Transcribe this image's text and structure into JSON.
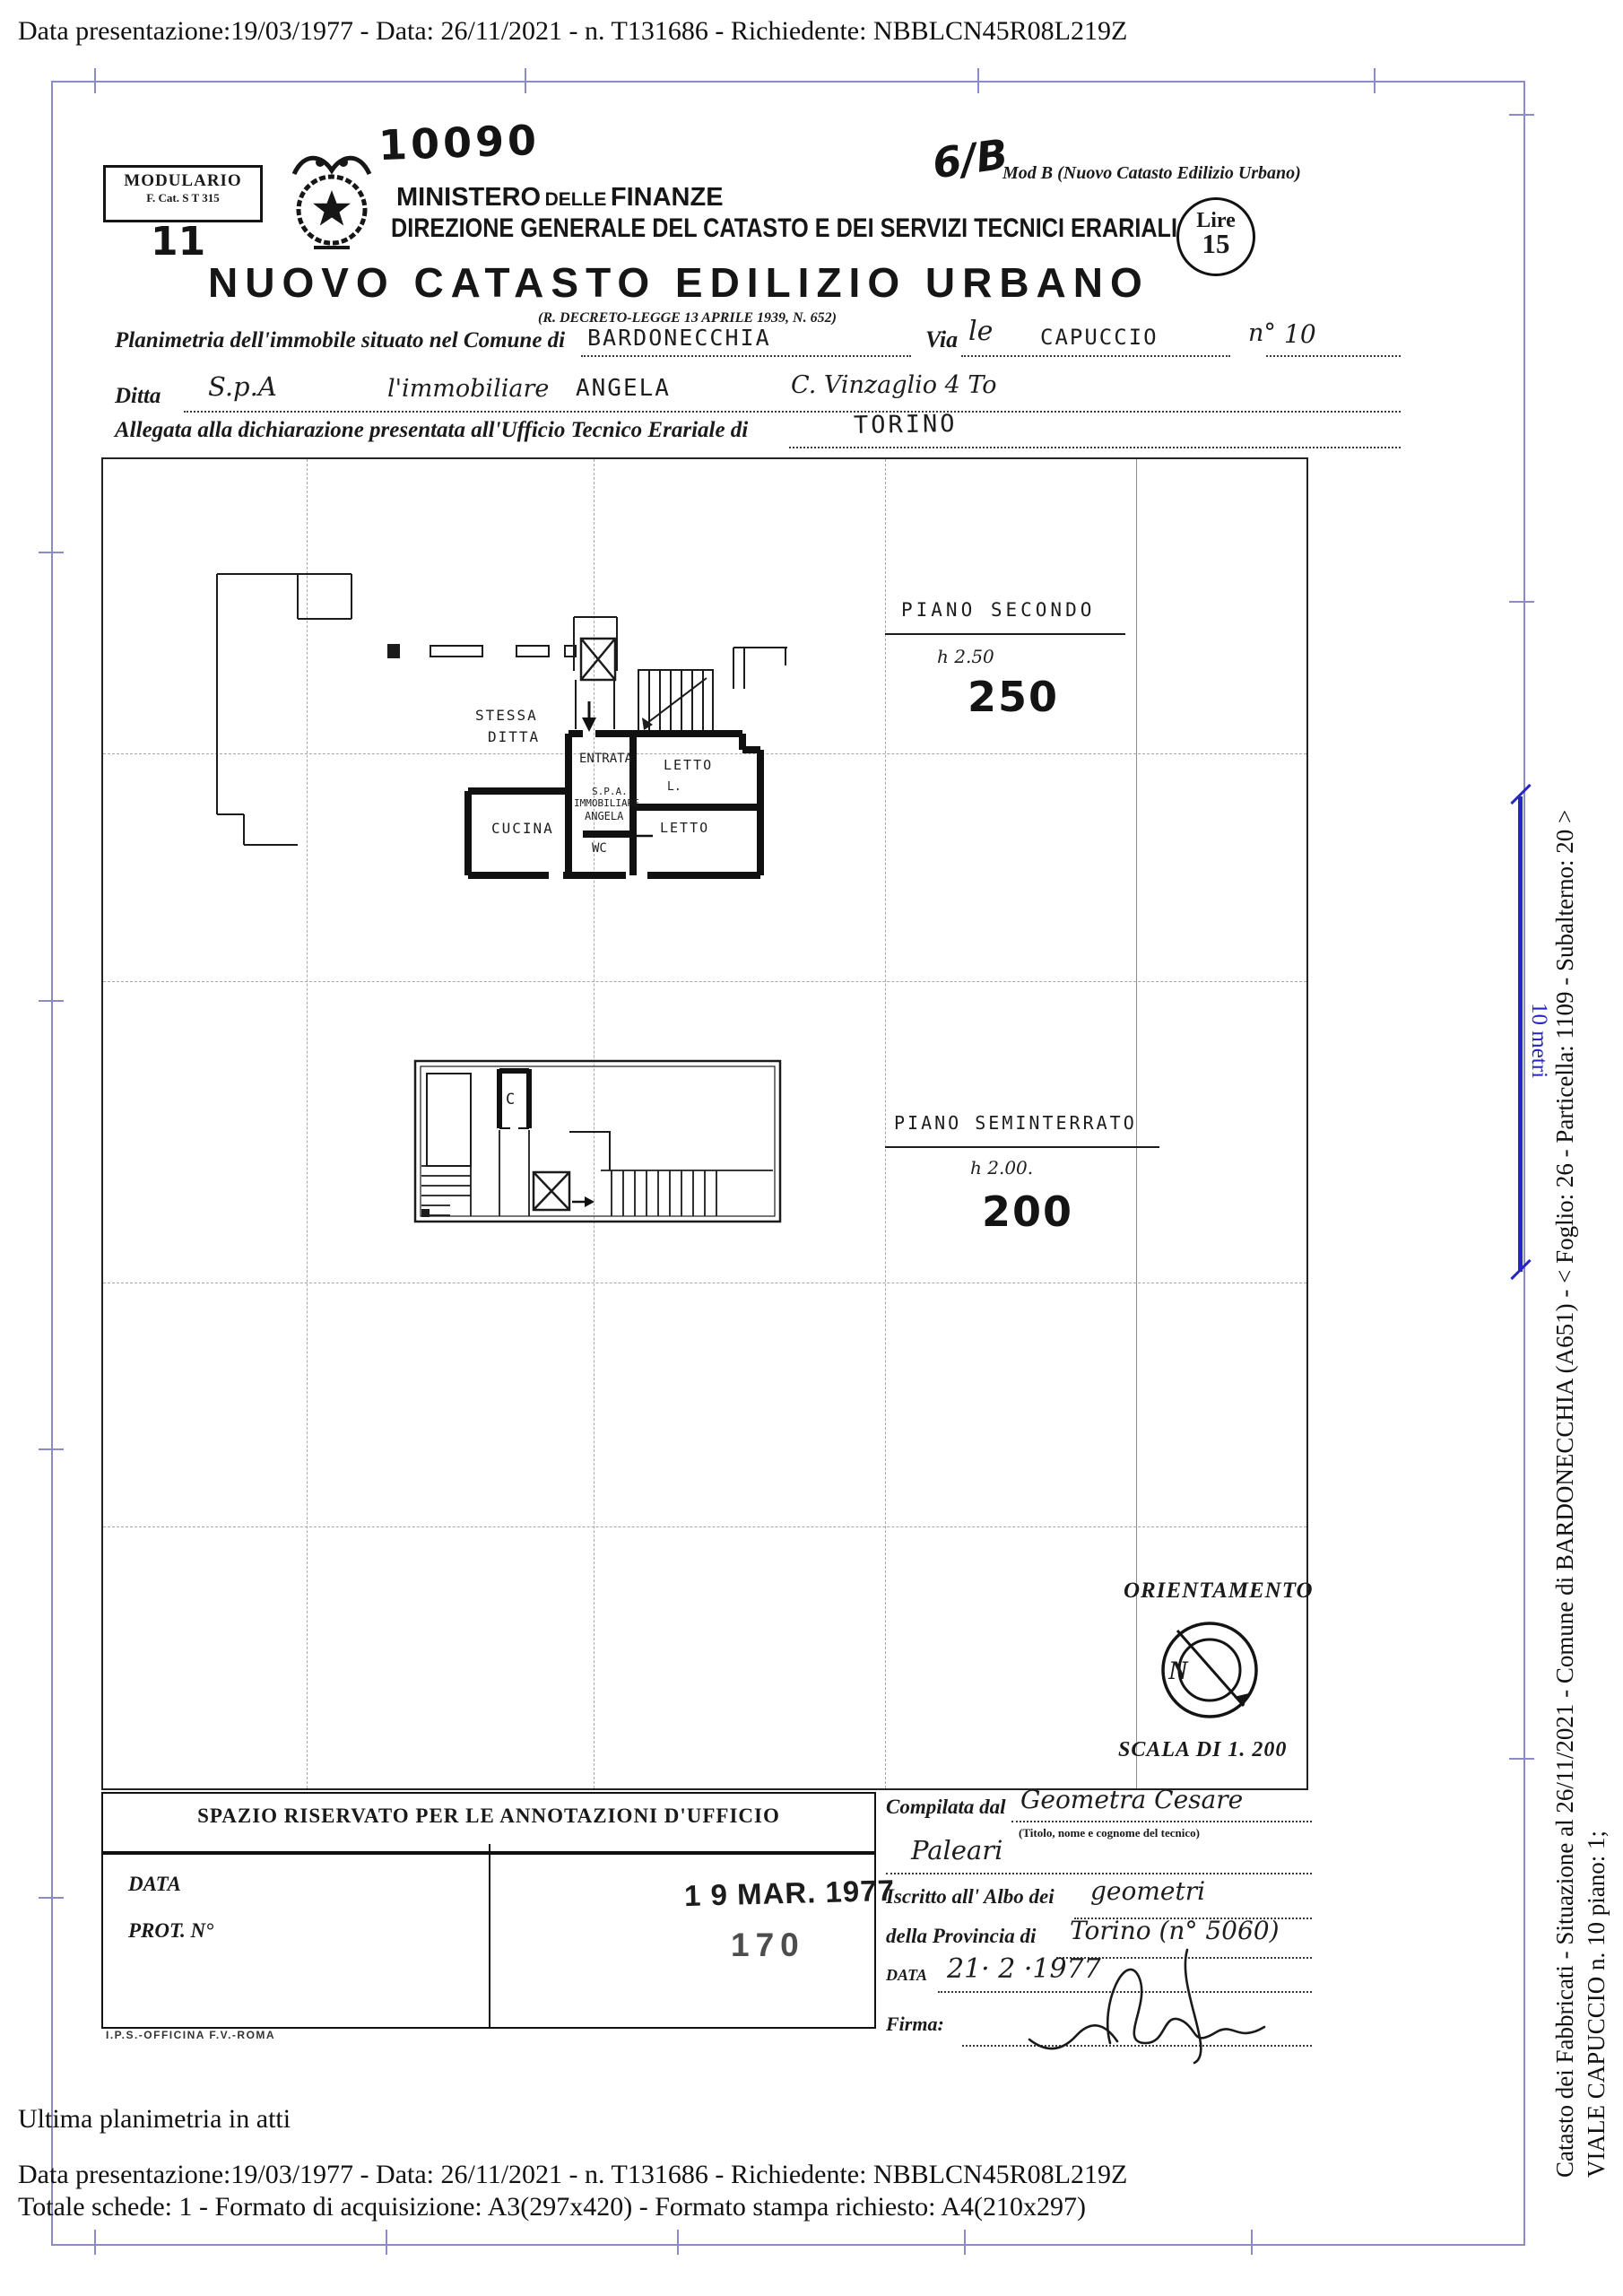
{
  "page": {
    "top_header": "Data presentazione:19/03/1977 - Data: 26/11/2021 - n. T131686 - Richiedente: NBBLCN45R08L219Z",
    "footer_note": "Ultima planimetria in atti",
    "footer_line1": "Data presentazione:19/03/1977 - Data: 26/11/2021 - n. T131686 - Richiedente: NBBLCN45R08L219Z",
    "footer_line2": "Totale schede: 1 - Formato di acquisizione: A3(297x420)  - Formato stampa richiesto: A4(210x297)"
  },
  "margin": {
    "line1": "Catasto dei Fabbricati - Situazione al 26/11/2021 - Comune di BARDONECCHIA (A651) - < Foglio: 26 - Particella: 1109 - Subalterno: 20 >",
    "line2": "VIALE CAPUCCIO n. 10 piano: 1;",
    "scale_label": "10 metri",
    "frame_color": "#8b8bcb",
    "scale_color": "#2626c4"
  },
  "letterhead": {
    "modulario_1": "MODULARIO",
    "modulario_2": "F.   Cat. S T    315",
    "hand_11": "11",
    "hand_10090": "10090",
    "ministero_1": "MINISTERO",
    "ministero_2": "DELLE",
    "ministero_3": "FINANZE",
    "direzione": "DIREZIONE GENERALE DEL CATASTO E DEI SERVIZI TECNICI ERARIALI",
    "hand_6b": "6/B",
    "mod_b": "Mod  B (Nuovo Catasto Edilizio Urbano)",
    "lire_label": "Lire",
    "lire_value": "15",
    "title": "NUOVO CATASTO EDILIZIO URBANO",
    "decree": "(R. DECRETO-LEGGE 13 APRILE 1939, N. 652)"
  },
  "form": {
    "line1_label": "Planimetria dell'immobile situato nel Comune di",
    "comune_value": "BARDONECCHIA",
    "via_label": "Via",
    "via_hand": "le",
    "via_value": "CAPUCCIO",
    "num_label": "n°",
    "num_value": "10",
    "ditta_label": "Ditta",
    "ditta_v1": "S.p.A",
    "ditta_v2": "l'immobiliare",
    "ditta_v3": "ANGELA",
    "ditta_v4": "C. Vinzaglio 4 To",
    "line3_label": "Allegata alla dichiarazione presentata all'Ufficio Tecnico Erariale di",
    "ufficio_value": "TORINO"
  },
  "plan": {
    "floor1": {
      "title": "PIANO  SECONDO",
      "height_label": "h    2.50",
      "hand_value": "250",
      "rooms": {
        "stessa_1": "STESSA",
        "stessa_2": "DITTA",
        "entrata": "ENTRATA",
        "letto1": "LETTO",
        "letto1_sub": "L.",
        "spa_1": "S.P.A.",
        "spa_2": "IMMOBILIARE",
        "spa_3": "ANGELA",
        "cucina": "CUCINA",
        "wc": "WC",
        "letto2": "LETTO"
      }
    },
    "floor2": {
      "title": "PIANO  SEMINTERRATO",
      "height_label": "h 2.00.",
      "hand_value": "200",
      "rooms": {
        "c": "C"
      }
    },
    "orientation_title": "ORIENTAMENTO",
    "north": "N",
    "scale_text": "SCALA DI 1. 200"
  },
  "annotations": {
    "header": "SPAZIO RISERVATO PER LE ANNOTAZIONI D'UFFICIO",
    "data_label": "DATA",
    "prot_label": "PROT. N°",
    "stamp_date": "1 9 MAR. 1977",
    "stamp_number": "170",
    "print_credit": "I.P.S.-OFFICINA F.V.-ROMA"
  },
  "compiler": {
    "compilata_label": "Compilata dal",
    "compilata_value": "Geometra   Cesare",
    "compilata_hint": "(Titolo, nome e cognome del tecnico)",
    "compilata_value2": "Paleari",
    "albo_label": "Iscritto all' Albo dei",
    "albo_value": "geometri",
    "provincia_label": "della Provincia di",
    "provincia_value": "Torino (n° 5060)",
    "data_label": "DATA",
    "data_value": "21· 2 ·1977",
    "firma_label": "Firma:"
  }
}
